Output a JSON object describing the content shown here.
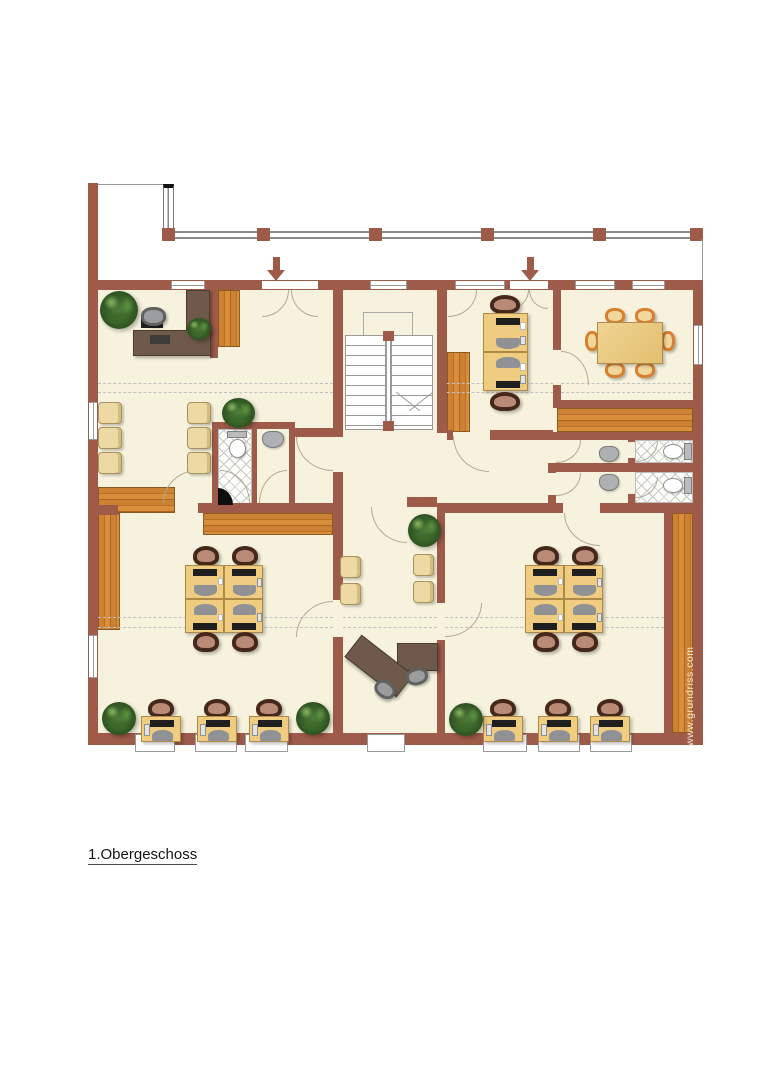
{
  "title": {
    "label": "1.Obergeschoss"
  },
  "watermark": {
    "label": "www.grundriss.com"
  },
  "palette": {
    "wall_brown": "#9e5b4a",
    "floor_cream": "#f6f2dd",
    "wood_orange": "#c97f2f",
    "desk_tan": "#f0cc80",
    "furniture_dark_brown": "#6e594a",
    "chair_dark": "#46281b",
    "chair_seat_rose": "#b98a76",
    "waiting_chair_tan": "#ecd9a4",
    "conference_chair_orange": "#d97f2e",
    "plant_green": "#4e7d3a",
    "tile_line_gray": "#c6c6c4",
    "outline_gray": "#9a9a9a"
  },
  "plan_features": {
    "type": "office floor plan",
    "staircase": "U-shaped double flight with center stringer",
    "entry_arrows": 2,
    "balcony_rail_posts": 6,
    "conference_table_seats": 6,
    "workstation_clusters": 2,
    "cluster_desks_each": 4,
    "window_row_desks": 6,
    "paired_desks": 2,
    "executive_l_desk": 1,
    "reception_counter": 1,
    "waiting_chairs": 10,
    "toilets": 3,
    "washbasins": 3,
    "plants": 7
  }
}
